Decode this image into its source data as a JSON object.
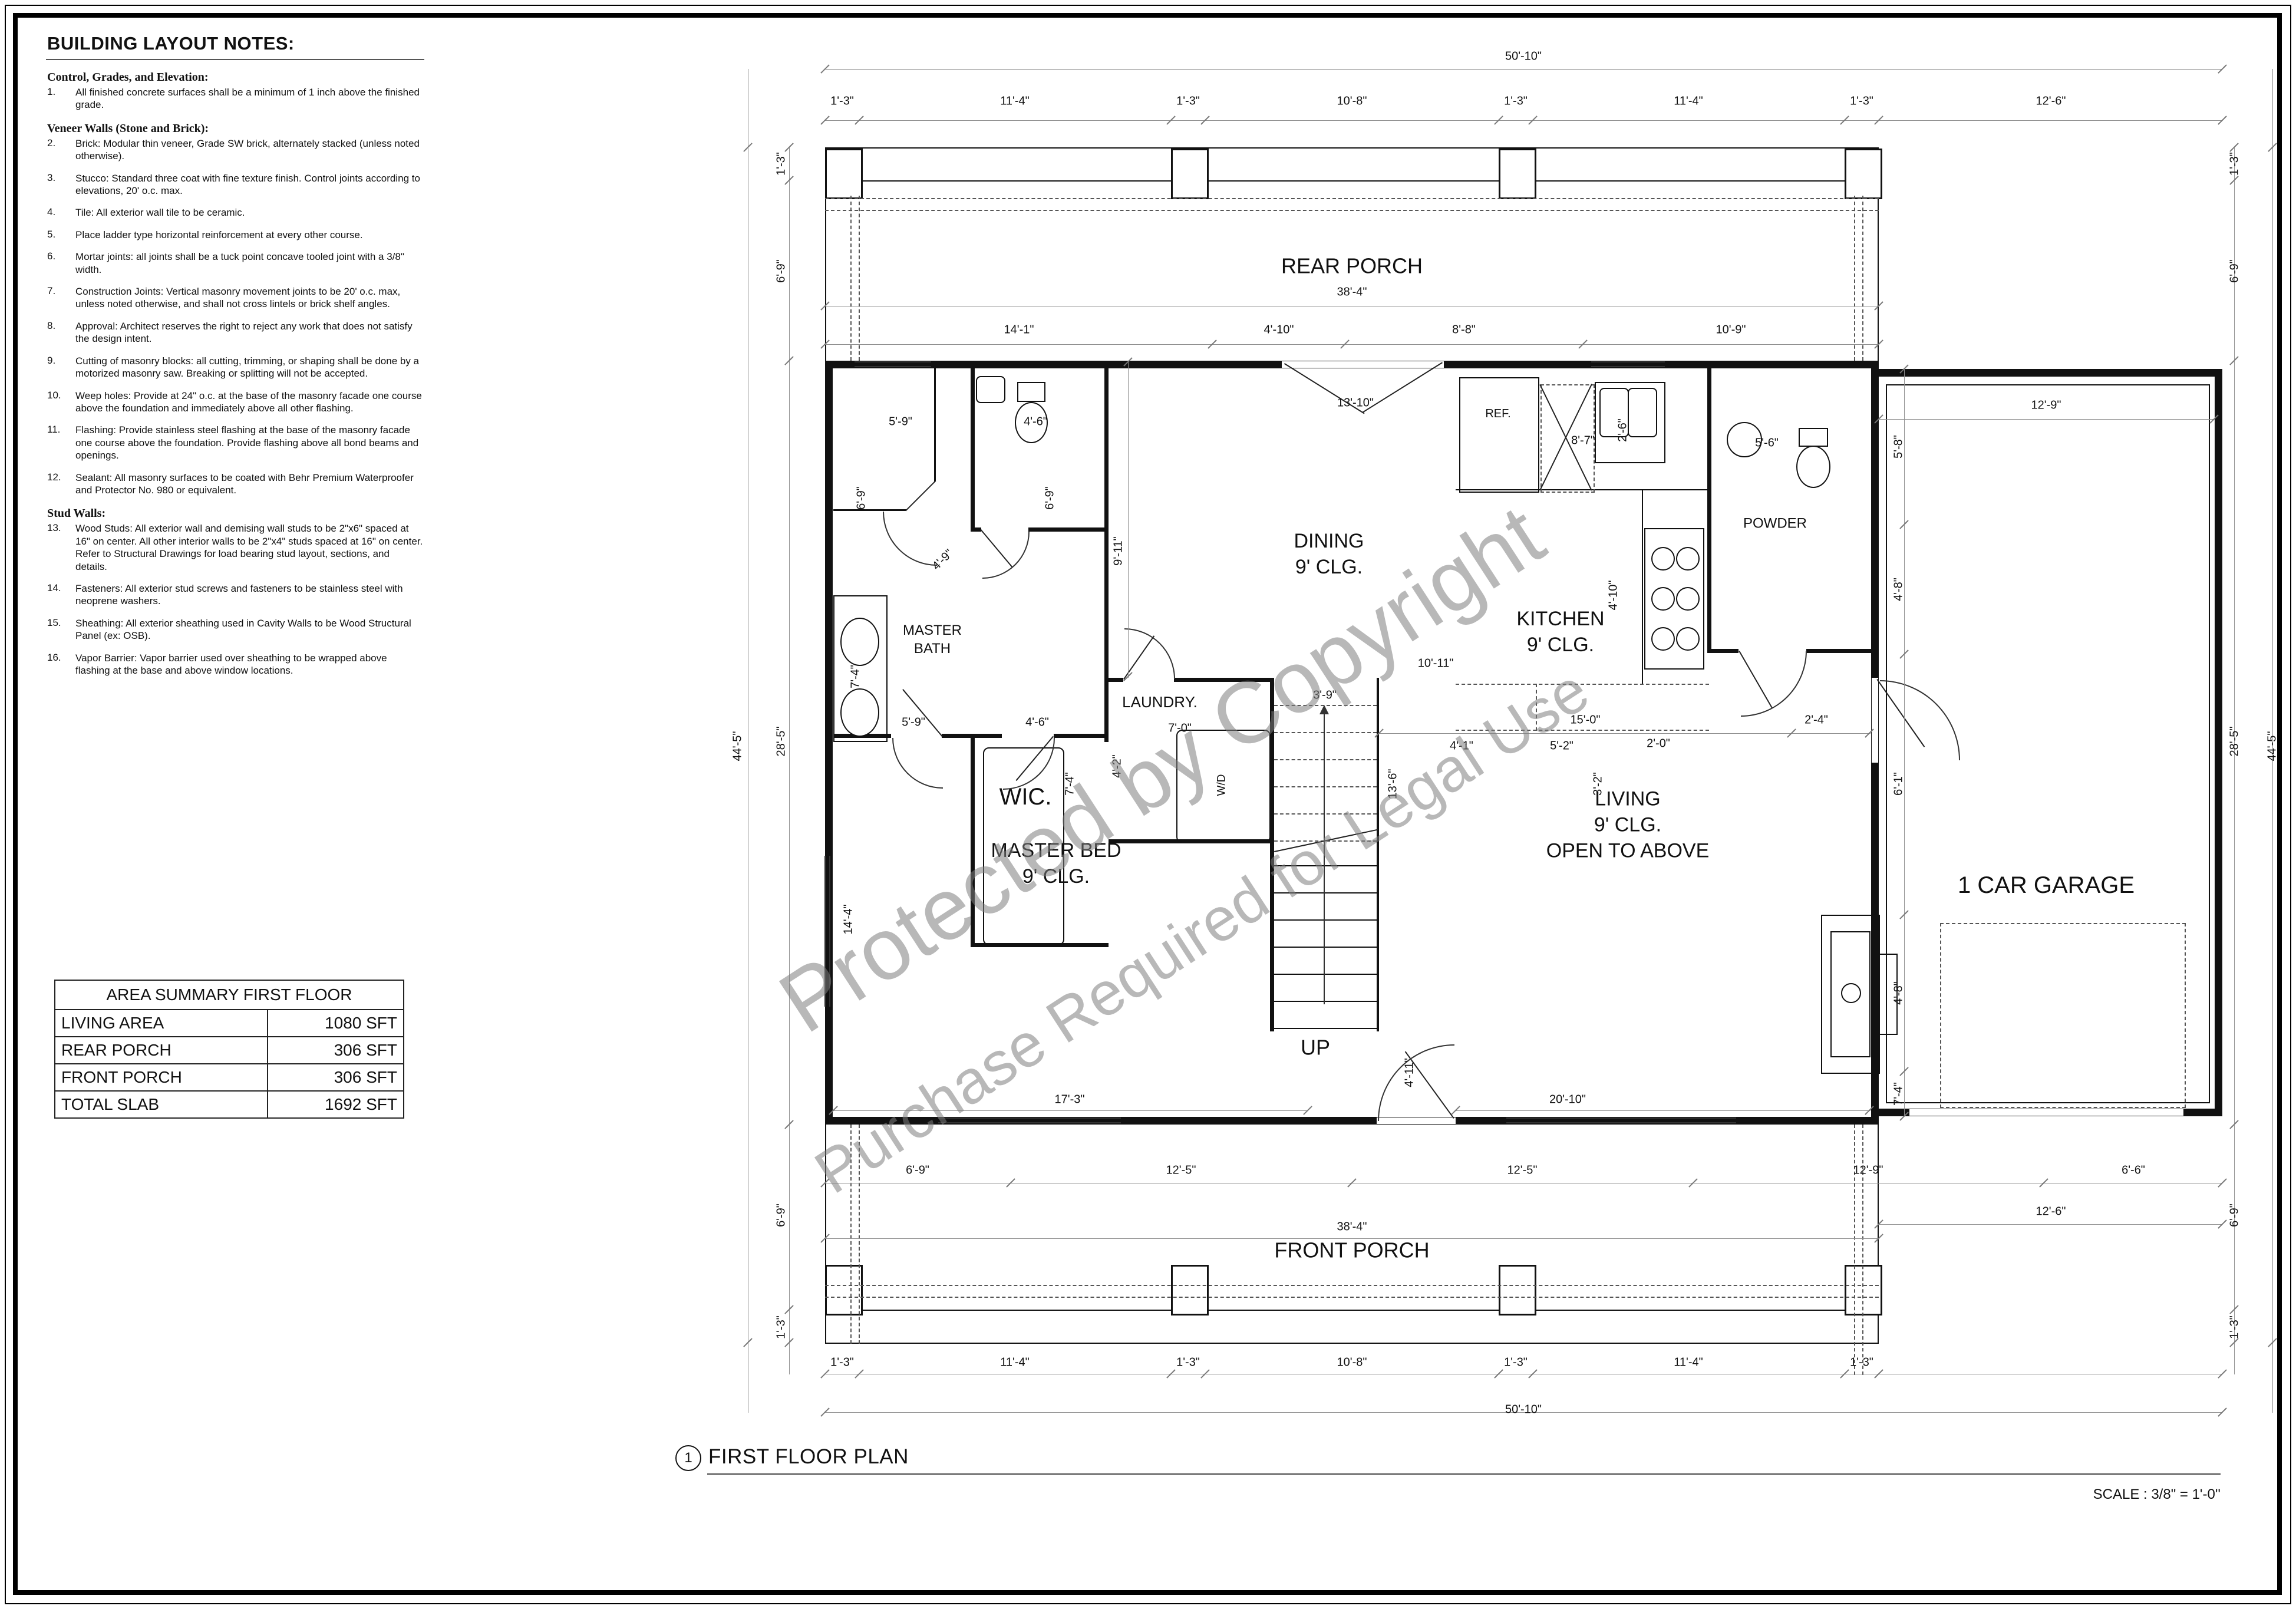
{
  "notes_panel": {
    "title": "BUILDING LAYOUT NOTES:",
    "sections": [
      {
        "heading": "Control, Grades, and Elevation:",
        "items": [
          {
            "num": "1.",
            "text": "All finished concrete surfaces shall be a minimum of 1 inch above the finished grade."
          }
        ]
      },
      {
        "heading": "Veneer Walls (Stone and Brick):",
        "items": [
          {
            "num": "2.",
            "text": "Brick: Modular thin veneer, Grade SW brick, alternately stacked (unless noted otherwise)."
          },
          {
            "num": "3.",
            "text": "Stucco: Standard three coat with fine texture finish. Control joints according to elevations, 20' o.c. max."
          },
          {
            "num": "4.",
            "text": "Tile: All exterior wall tile to be ceramic."
          },
          {
            "num": "5.",
            "text": "Place ladder type horizontal reinforcement at every other course."
          },
          {
            "num": "6.",
            "text": "Mortar joints: all joints shall be a tuck point concave tooled joint with a 3/8\" width."
          },
          {
            "num": "7.",
            "text": "Construction Joints: Vertical masonry movement joints to be 20' o.c. max, unless noted otherwise, and shall not cross lintels or brick shelf angles."
          },
          {
            "num": "8.",
            "text": "Approval: Architect reserves the right to reject any work that does not satisfy the design intent."
          },
          {
            "num": "9.",
            "text": "Cutting of masonry blocks: all cutting, trimming, or shaping shall be done by a motorized masonry saw. Breaking or splitting will not be accepted."
          },
          {
            "num": "10.",
            "text": "Weep holes: Provide at 24\" o.c. at the base of the masonry facade one course above the foundation and immediately above all other flashing."
          },
          {
            "num": "11.",
            "text": "Flashing: Provide stainless steel flashing at the base of the masonry facade one course above the foundation. Provide flashing above all bond beams and openings."
          },
          {
            "num": "12.",
            "text": "Sealant: All masonry surfaces to be coated with Behr Premium Waterproofer and Protector No. 980 or equivalent."
          }
        ]
      },
      {
        "heading": "Stud Walls:",
        "items": [
          {
            "num": "13.",
            "text": "Wood Studs: All exterior wall and demising wall studs to be 2\"x6\" spaced at 16\" on center. All other interior walls to be 2\"x4\" studs spaced at 16\" on center. Refer to Structural Drawings for load bearing stud layout, sections, and details."
          },
          {
            "num": "14.",
            "text": "Fasteners: All exterior stud screws and fasteners to be stainless steel with neoprene washers."
          },
          {
            "num": "15.",
            "text": "Sheathing: All exterior sheathing used in Cavity Walls to be Wood Structural Panel (ex: OSB)."
          },
          {
            "num": "16.",
            "text": "Vapor Barrier: Vapor barrier used over sheathing to be wrapped above flashing at the base and above window locations."
          }
        ]
      }
    ]
  },
  "area_table": {
    "title": "AREA SUMMARY FIRST FLOOR",
    "rows": [
      {
        "label": "LIVING AREA",
        "value": "1080 SFT"
      },
      {
        "label": "REAR PORCH",
        "value": "306 SFT"
      },
      {
        "label": "FRONT PORCH",
        "value": "306 SFT"
      },
      {
        "label": "TOTAL SLAB",
        "value": "1692 SFT"
      }
    ]
  },
  "watermark": {
    "line1": "Protected by Copyright",
    "line2": "Purchase Required for Legal Use"
  },
  "plan": {
    "rooms": {
      "rear_porch": "REAR PORCH",
      "dining": "DINING\n9' CLG.",
      "kitchen": "KITCHEN\n9' CLG.",
      "powder": "POWDER",
      "master_bath": "MASTER\nBATH",
      "wic": "WIC.",
      "laundry": "LAUNDRY.",
      "master_bed": "MASTER BED\n9' CLG.",
      "living": "LIVING\n9' CLG.\nOPEN TO ABOVE",
      "garage": "1 CAR GARAGE",
      "up": "UP",
      "front_porch": "FRONT PORCH",
      "ref": "REF.",
      "wd": "W/D"
    },
    "dims": [
      {
        "id": "T0",
        "t": "50'-10\""
      },
      {
        "id": "T1",
        "t": "1'-3\""
      },
      {
        "id": "T2",
        "t": "11'-4\""
      },
      {
        "id": "T3",
        "t": "1'-3\""
      },
      {
        "id": "T4",
        "t": "10'-8\""
      },
      {
        "id": "T5",
        "t": "1'-3\""
      },
      {
        "id": "T6",
        "t": "11'-4\""
      },
      {
        "id": "T7",
        "t": "1'-3\""
      },
      {
        "id": "T8",
        "t": "12'-6\""
      },
      {
        "id": "T9",
        "t": "38'-4\""
      },
      {
        "id": "T10",
        "t": "14'-1\""
      },
      {
        "id": "T11",
        "t": "4'-10\""
      },
      {
        "id": "T12",
        "t": "8'-8\""
      },
      {
        "id": "T13",
        "t": "10'-9\""
      },
      {
        "id": "T14",
        "t": "12'-9\""
      },
      {
        "id": "L0",
        "t": "44'-5\""
      },
      {
        "id": "L1",
        "t": "1'-3\""
      },
      {
        "id": "L2",
        "t": "6'-9\""
      },
      {
        "id": "L3",
        "t": "28'-5\""
      },
      {
        "id": "L4",
        "t": "6'-9\""
      },
      {
        "id": "L5",
        "t": "1'-3\""
      },
      {
        "id": "R0",
        "t": "1'-3\""
      },
      {
        "id": "R1",
        "t": "6'-9\""
      },
      {
        "id": "R2",
        "t": "28'-5\""
      },
      {
        "id": "R3",
        "t": "6'-9\""
      },
      {
        "id": "R4",
        "t": "1'-3\""
      },
      {
        "id": "R5",
        "t": "44'-5\""
      },
      {
        "id": "G0",
        "t": "5'-8\""
      },
      {
        "id": "G1",
        "t": "4'-8\""
      },
      {
        "id": "G2",
        "t": "6'-1\""
      },
      {
        "id": "G3",
        "t": "4'-8\""
      },
      {
        "id": "G4",
        "t": "7'-4\""
      },
      {
        "id": "I0",
        "t": "5'-9\""
      },
      {
        "id": "I1",
        "t": "4'-6\""
      },
      {
        "id": "I2",
        "t": "6'-9\""
      },
      {
        "id": "I3",
        "t": "6'-9\""
      },
      {
        "id": "I4",
        "t": "4'-9\""
      },
      {
        "id": "I5",
        "t": "7'-4\""
      },
      {
        "id": "I6",
        "t": "5'-9\""
      },
      {
        "id": "I7",
        "t": "4'-6\""
      },
      {
        "id": "I8",
        "t": "9'-11\""
      },
      {
        "id": "I9",
        "t": "13'-10\""
      },
      {
        "id": "I10",
        "t": "10'-11\""
      },
      {
        "id": "I11",
        "t": "8'-7\""
      },
      {
        "id": "I12",
        "t": "2'-6\""
      },
      {
        "id": "I13",
        "t": "4'-10\""
      },
      {
        "id": "I14",
        "t": "5'-6\""
      },
      {
        "id": "I15",
        "t": "4'-1\""
      },
      {
        "id": "I16",
        "t": "5'-2\""
      },
      {
        "id": "I17",
        "t": "2'-0\""
      },
      {
        "id": "I18",
        "t": "3'-2\""
      },
      {
        "id": "I19",
        "t": "7'-4\""
      },
      {
        "id": "I20",
        "t": "4'-2\""
      },
      {
        "id": "I21",
        "t": "7'-0\""
      },
      {
        "id": "I22",
        "t": "3'-9\""
      },
      {
        "id": "I23",
        "t": "13'-6\""
      },
      {
        "id": "I24",
        "t": "15'-0\""
      },
      {
        "id": "I25",
        "t": "2'-4\""
      },
      {
        "id": "I26",
        "t": "14'-4\""
      },
      {
        "id": "I27",
        "t": "17'-3\""
      },
      {
        "id": "I28",
        "t": "4'-11\""
      },
      {
        "id": "I29",
        "t": "20'-10\""
      },
      {
        "id": "B0",
        "t": "6'-9\""
      },
      {
        "id": "B1",
        "t": "12'-5\""
      },
      {
        "id": "B2",
        "t": "12'-5\""
      },
      {
        "id": "B3",
        "t": "12'-9\""
      },
      {
        "id": "B4",
        "t": "6'-6\""
      },
      {
        "id": "B5",
        "t": "12'-6\""
      },
      {
        "id": "B6",
        "t": "38'-4\""
      },
      {
        "id": "B7",
        "t": "1'-3\""
      },
      {
        "id": "B8",
        "t": "11'-4\""
      },
      {
        "id": "B9",
        "t": "1'-3\""
      },
      {
        "id": "B10",
        "t": "10'-8\""
      },
      {
        "id": "B11",
        "t": "1'-3\""
      },
      {
        "id": "B12",
        "t": "11'-4\""
      },
      {
        "id": "B13",
        "t": "1'-3\""
      },
      {
        "id": "B14",
        "t": "50'-10\""
      }
    ]
  },
  "footer": {
    "sheet_number": "1",
    "title": "FIRST FLOOR PLAN",
    "scale": "SCALE : 3/8\" = 1'-0''"
  }
}
